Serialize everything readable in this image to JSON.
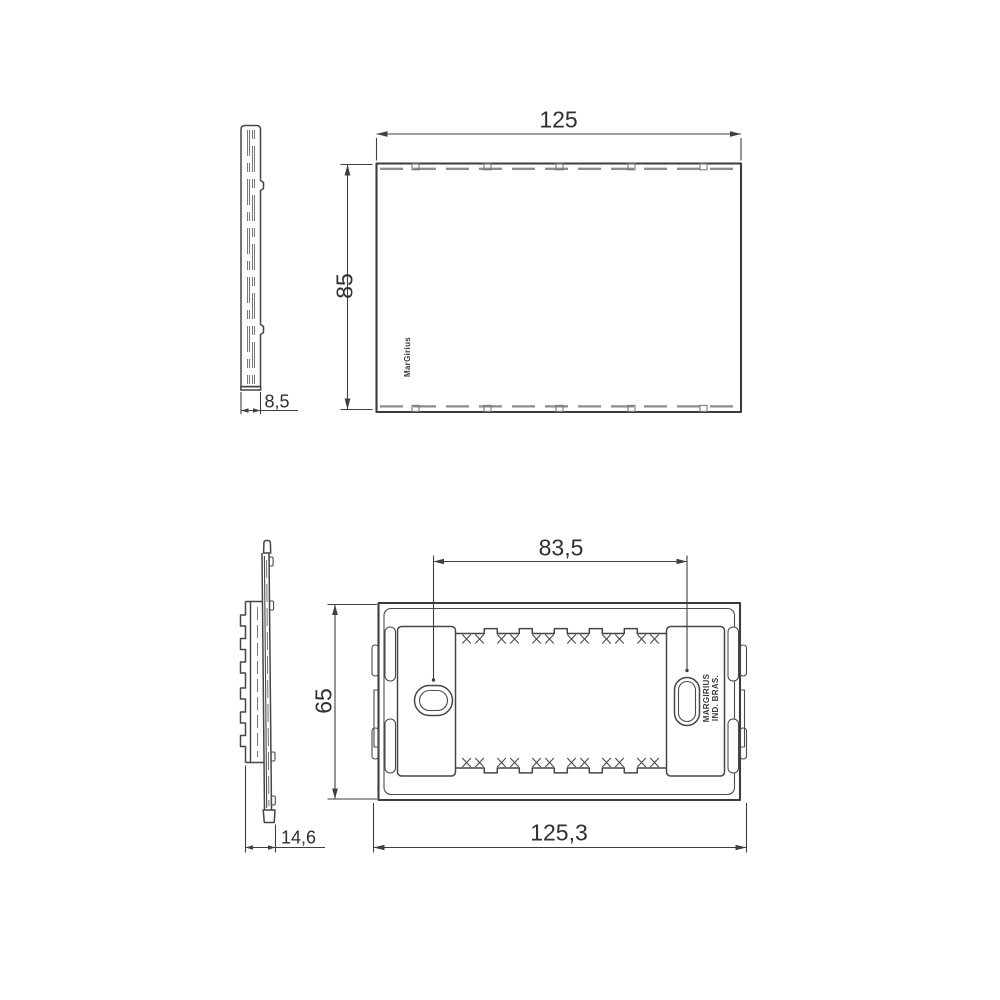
{
  "page": {
    "background": "#ffffff"
  },
  "drawing": {
    "line_color": "#3c3c3c",
    "dimension_color": "#2f2f2f",
    "hidden_line_color": "#8c8c8c"
  },
  "figure1": {
    "name": "cover-plate-views",
    "dim_width": "125",
    "dim_height": "85",
    "dim_depth": "8,5",
    "brand": "MarGirius"
  },
  "figure2": {
    "name": "mounting-frame-views",
    "dim_hole_spacing": "83,5",
    "dim_height": "65",
    "dim_width": "125,3",
    "dim_depth": "14,6",
    "brand_line1": "MARGIRIUS",
    "brand_line2": "IND. BRAS."
  }
}
